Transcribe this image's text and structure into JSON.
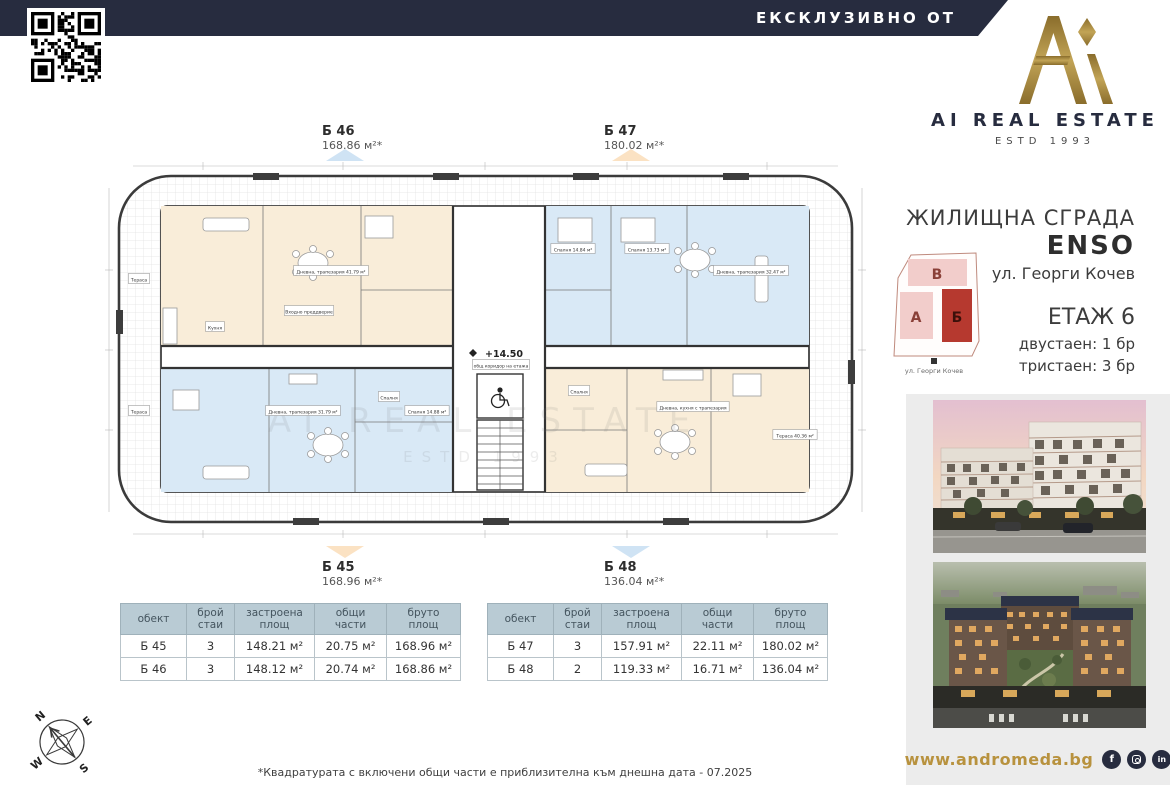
{
  "colors": {
    "navy": "#272c3f",
    "gold": "#a08236",
    "website_gold": "#b8923e",
    "room_cream": "#f9edd9",
    "room_blue": "#d9e9f6",
    "marker_blue": "#cfe3f4",
    "marker_cream": "#fbe2c3",
    "table_header_bg": "#b9cbd4",
    "map_pink": "#f2cdcb",
    "map_red": "#b6392f",
    "side_panel_gray": "#ececec"
  },
  "top": {
    "banner": "ЕКСКЛУЗИВНО ОТ"
  },
  "brand": {
    "name": "AI REAL ESTATE",
    "estd": "ESTD 1993"
  },
  "info": {
    "type": "ЖИЛИЩНА СГРАДА",
    "name": "ENSO",
    "address": "ул. Георги Кочев",
    "floor": "ЕТАЖ 6",
    "units": [
      "двустаен: 1 бр",
      "тристаен: 3 бр"
    ]
  },
  "site_map": {
    "blocks": [
      "В",
      "А",
      "Б"
    ],
    "highlighted": "Б",
    "street": "ул. Георги Кочев"
  },
  "plan": {
    "level": "+14.50",
    "watermark": {
      "line1": "AI REAL ESTATE",
      "line2": "ESTD 1993"
    },
    "apartments": [
      {
        "id": "Б 46",
        "area": "168.86 м²*",
        "position": "top-left",
        "marker": "blue"
      },
      {
        "id": "Б 47",
        "area": "180.02 м²*",
        "position": "top-right",
        "marker": "cream"
      },
      {
        "id": "Б 45",
        "area": "168.96 м²*",
        "position": "bottom-left",
        "marker": "cream"
      },
      {
        "id": "Б 48",
        "area": "136.04 м²*",
        "position": "bottom-right",
        "marker": "blue"
      }
    ],
    "room_labels": [
      {
        "x": 228,
        "y": 112,
        "t": "Дневна, трапезария 41.79 м²"
      },
      {
        "x": 112,
        "y": 168,
        "t": "Кухня"
      },
      {
        "x": 206,
        "y": 152,
        "t": "Входно преддверие"
      },
      {
        "x": 470,
        "y": 90,
        "t": "Спалня 14.84 м²"
      },
      {
        "x": 544,
        "y": 90,
        "t": "Спалня 13.73 м²"
      },
      {
        "x": 648,
        "y": 112,
        "t": "Дневна, трапезария 32.47 м²"
      },
      {
        "x": 200,
        "y": 252,
        "t": "Дневна, трапезария 31.79 м²"
      },
      {
        "x": 286,
        "y": 238,
        "t": "Спалня"
      },
      {
        "x": 324,
        "y": 252,
        "t": "Спалня 14.88 м²"
      },
      {
        "x": 590,
        "y": 248,
        "t": "Дневна, кухня с трапезария"
      },
      {
        "x": 476,
        "y": 232,
        "t": "Спалня"
      },
      {
        "x": 692,
        "y": 276,
        "t": "Тераса 40.36 м²"
      },
      {
        "x": 36,
        "y": 120,
        "t": "Тераса"
      },
      {
        "x": 36,
        "y": 252,
        "t": "Тераса"
      },
      {
        "x": 398,
        "y": 206,
        "t": "общ коридор на етажа"
      }
    ]
  },
  "tables": [
    {
      "headers": [
        "обект",
        "брой\nстаи",
        "застроена\nплощ",
        "общи части",
        "бруто\nплощ"
      ],
      "rows": [
        [
          "Б 45",
          "3",
          "148.21 м²",
          "20.75 м²",
          "168.96 м²"
        ],
        [
          "Б 46",
          "3",
          "148.12 м²",
          "20.74 м²",
          "168.86 м²"
        ]
      ]
    },
    {
      "headers": [
        "обект",
        "брой\nстаи",
        "застроена\nплощ",
        "общи части",
        "бруто\nплощ"
      ],
      "rows": [
        [
          "Б 47",
          "3",
          "157.91 м²",
          "22.11 м²",
          "180.02 м²"
        ],
        [
          "Б 48",
          "2",
          "119.33 м²",
          "16.71 м²",
          "136.04 м²"
        ]
      ]
    }
  ],
  "footnote": "*Квадратурата с включени общи части е приблизителна към днешна дата - 07.2025",
  "footer": {
    "website": "www.andromeda.bg",
    "social": [
      "facebook",
      "instagram",
      "linkedin"
    ]
  },
  "compass": {
    "n": "N",
    "e": "E",
    "s": "S",
    "w": "W"
  }
}
